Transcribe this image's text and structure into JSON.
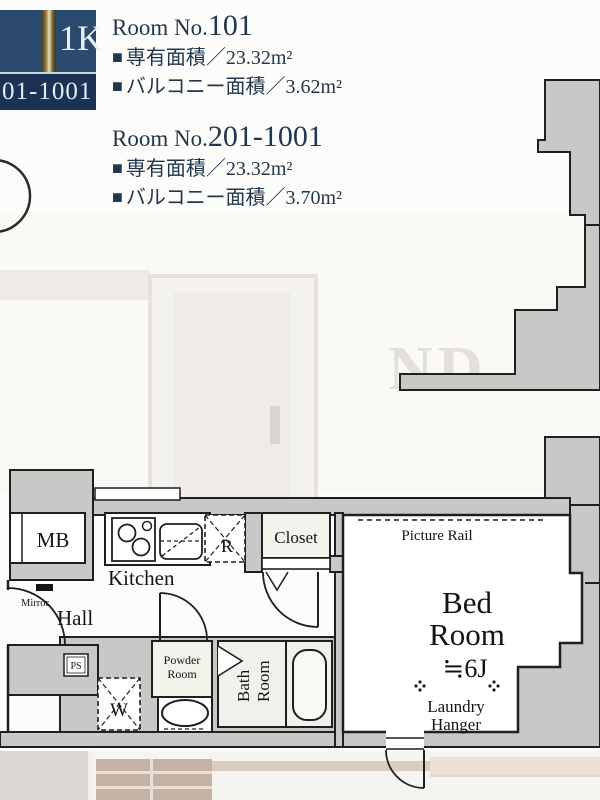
{
  "badge": {
    "floor_type": "1K",
    "room_range": "01-1001"
  },
  "bullet": "■",
  "units": [
    {
      "label_prefix": "Room No.",
      "label_number": "101",
      "exclusive_area": "専有面積／23.32m²",
      "balcony_area": "バルコニー面積／3.62m²"
    },
    {
      "label_prefix": "Room No.",
      "label_number": "201-1001",
      "exclusive_area": "専有面積／23.32m²",
      "balcony_area": "バルコニー面積／3.70m²"
    }
  ],
  "watermark": "ND",
  "floorplan": {
    "labels": {
      "mb": "MB",
      "kitchen": "Kitchen",
      "mirror": "Mirror",
      "hall": "Hall",
      "ps": "PS",
      "washer": "W",
      "fridge": "R",
      "powder_line1": "Powder",
      "powder_line2": "Room",
      "bath_line1": "Bath",
      "bath_line2": "Room",
      "closet": "Closet",
      "picture_rail": "Picture Rail",
      "bedroom_line1": "Bed",
      "bedroom_line2": "Room",
      "bedroom_size": "≒6J",
      "laundry_line1": "Laundry",
      "laundry_line2": "Hanger"
    }
  },
  "colors": {
    "badge_navy": "#2c4a6e",
    "badge_navy_dark": "#1c3254",
    "badge_gold": "#c9b878",
    "info_text": "#22374d",
    "wall_gray": "#c8c8c6",
    "line_black": "#1f1f1f",
    "room_cream": "#f1f4ea",
    "photo_tan": "#c4b3a4"
  }
}
